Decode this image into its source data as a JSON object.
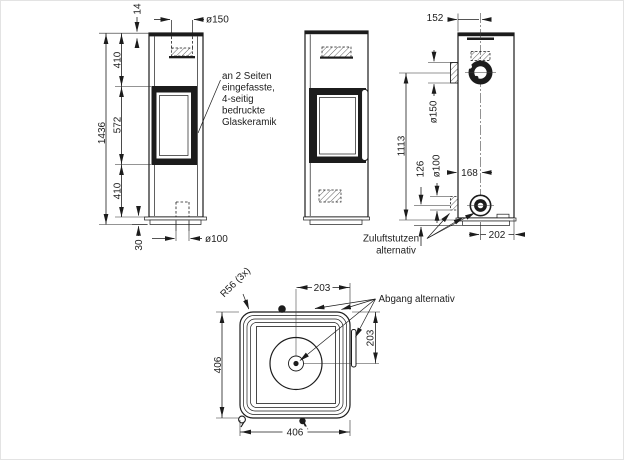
{
  "annotations": {
    "glass_note_lines": [
      "an 2 Seiten",
      "eingefasste,",
      "4-seitig",
      "bedruckte",
      "Glaskeramik"
    ],
    "zuluft_lines": [
      "Zuluftstutzen",
      "alternativ"
    ],
    "abgang": "Abgang alternativ",
    "radius": "R56 (3x)"
  },
  "dimensions": {
    "front": {
      "top_plate": "14",
      "flue_diameter": "ø150",
      "upper_section": "410",
      "window_section": "572",
      "lower_section": "410",
      "total_height": "1436",
      "plinth_height": "30",
      "floor_pipe_diameter": "ø100"
    },
    "rear": {
      "flue_center_offset": "152",
      "rear_stub_diameter": "ø150",
      "flue_center_height": "1113",
      "lower_stub_height": "126",
      "lower_stub_diameter": "ø100",
      "side_to_center": "168",
      "center_to_edge": "202"
    },
    "top": {
      "center_to_right": "203",
      "top_to_center": "203",
      "depth": "406",
      "width": "406"
    }
  }
}
